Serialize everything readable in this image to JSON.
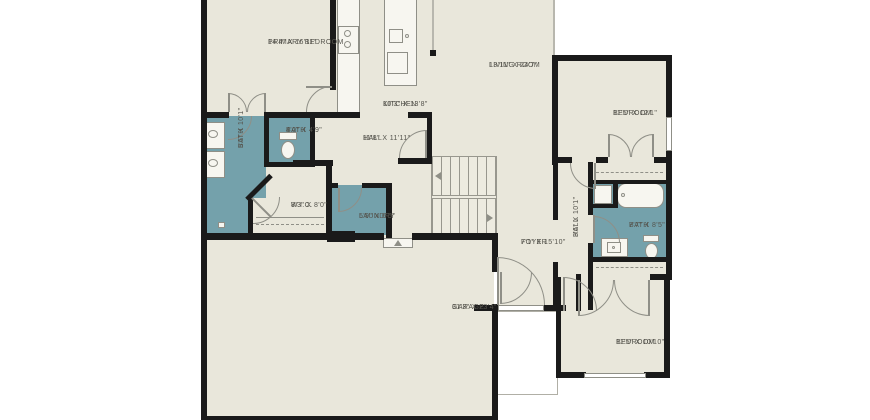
{
  "plan_title": "single-story floor plan",
  "colors": {
    "background": "#ffffff",
    "floor": "#e9e7db",
    "wet_rooms": "#74a1ab",
    "walls": "#1a1a1a",
    "fixture_lines": "#8f8f87",
    "label_text": "#55544d"
  },
  "rooms": {
    "primary_bedroom": {
      "name": "PRIMARY BEDROOM",
      "dims": "14'4\" X 16'11\""
    },
    "kitchen": {
      "name": "KITCHEN",
      "dims": "10'3\" X 13'8\""
    },
    "living_room": {
      "name": "LIVING ROOM",
      "dims": "13'11\" X 24'7\""
    },
    "bedroom_top_right": {
      "name": "BEDROOM",
      "dims": "11'5\" X 12'1\""
    },
    "bath_primary": {
      "name": "BATH",
      "dims": "5'5\" X 10'1\""
    },
    "bath_small": {
      "name": "BATH",
      "dims": "4'0\" X 4'9\""
    },
    "hall_main": {
      "name": "HALL",
      "dims": "11'8\" X 11'11\""
    },
    "wic": {
      "name": "W.I.C.",
      "dims": "8'3\" X 8'0\""
    },
    "laundry": {
      "name": "LAUNDRY",
      "dims": "5'9\" X 6'5\""
    },
    "foyer": {
      "name": "FOYER",
      "dims": "7'1\" X 15'10\""
    },
    "hall_right": {
      "name": "HALL",
      "dims": "3'6\" X 10'1\""
    },
    "bath_right": {
      "name": "BATH",
      "dims": "7'7\" X 8'5\""
    },
    "bedroom_bottom_right": {
      "name": "BEDROOM",
      "dims": "11'5\" X 10'10\""
    },
    "garage": {
      "name": "GARAGE",
      "dims": "31'3\" X 23'4\""
    }
  }
}
